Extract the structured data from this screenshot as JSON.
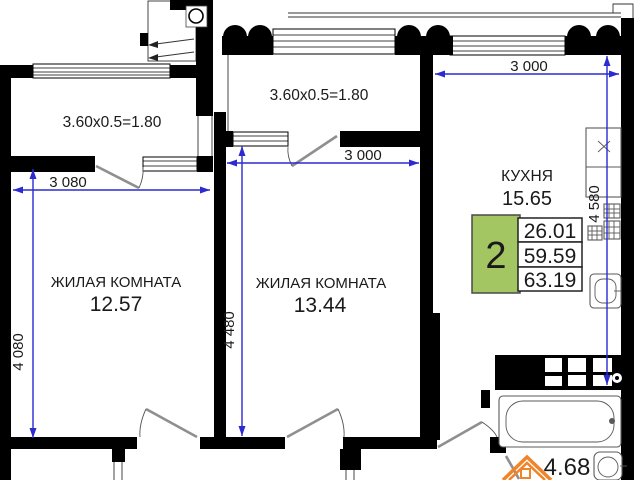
{
  "colors": {
    "wall": "#000000",
    "dimension": "#2b2bd0",
    "label": "#1a1a1a",
    "badge_green": "#a3c562",
    "door": "#8f8f8f",
    "fixture": "#5a5a5a",
    "watermark": "#f08428"
  },
  "rooms": {
    "living1": {
      "label": "ЖИЛАЯ КОМНАТА",
      "area": "12.57"
    },
    "living2": {
      "label": "ЖИЛАЯ КОМНАТА",
      "area": "13.44"
    },
    "kitchen": {
      "label": "КУХНЯ",
      "area": "15.65"
    },
    "bathroom": {
      "area": "4.68"
    }
  },
  "windows": {
    "left_balcony": "3.60x0.5=1.80",
    "middle_balcony": "3.60x0.5=1.80"
  },
  "dimensions": {
    "living1_width": "3 080",
    "living1_depth": "4 080",
    "living2_width": "3 000",
    "living2_depth": "4 480",
    "kitchen_width": "3 000",
    "kitchen_depth": "4 580"
  },
  "info_badge": {
    "room_count": "2",
    "areas": [
      "26.01",
      "59.59",
      "63.19"
    ]
  }
}
